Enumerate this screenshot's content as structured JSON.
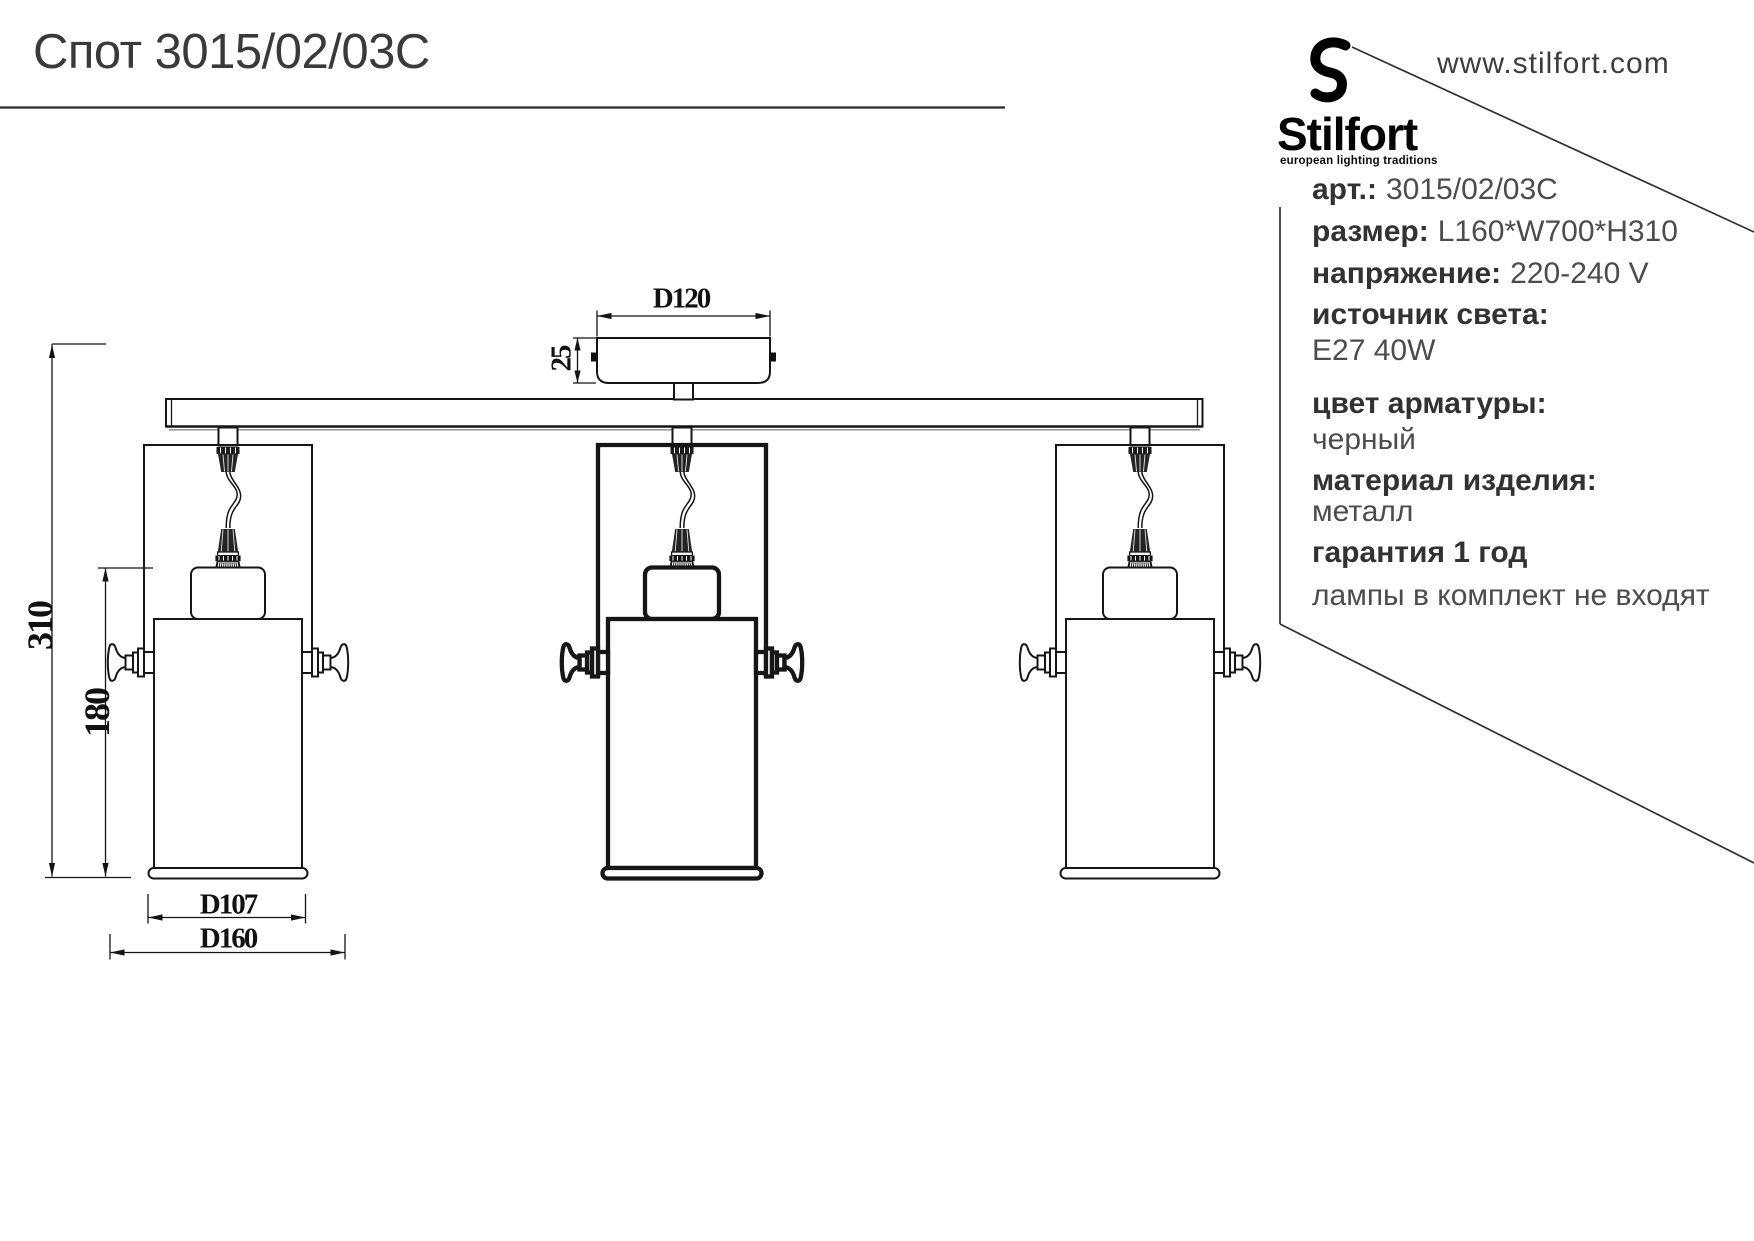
{
  "title": "Спот 3015/02/03C",
  "brand": {
    "logo_glyph": "S",
    "name": "Stilfort",
    "tagline": "european lighting traditions",
    "website": "www.stilfort.com"
  },
  "specs": {
    "rows": [
      {
        "label": "арт.:",
        "value": "3015/02/03C"
      },
      {
        "label": "размер:",
        "value": "L160*W700*H310"
      },
      {
        "label": "напряжение:",
        "value": "220-240 V"
      },
      {
        "label": "источник света:",
        "value": ""
      },
      {
        "label": "",
        "value": "E27 40W"
      },
      {
        "label": "цвет арматуры:",
        "value": ""
      },
      {
        "label": "",
        "value": "черный"
      },
      {
        "label": "материал изделия:",
        "value": ""
      },
      {
        "label": "",
        "value": "металл"
      },
      {
        "label": "гарантия 1 год",
        "value": ""
      },
      {
        "label": "",
        "value": "лампы в  комплект не входят"
      }
    ]
  },
  "dimensions": {
    "canopy_diameter": "D120",
    "canopy_height": "25",
    "total_height": "310",
    "shade_height": "180",
    "shade_diameter": "D107",
    "total_width": "D160"
  },
  "colors": {
    "line": "#161616",
    "title_text": "#3a3a3a",
    "label_text": "#323232",
    "value_text": "#4c4c4c",
    "logo": "#000000"
  }
}
